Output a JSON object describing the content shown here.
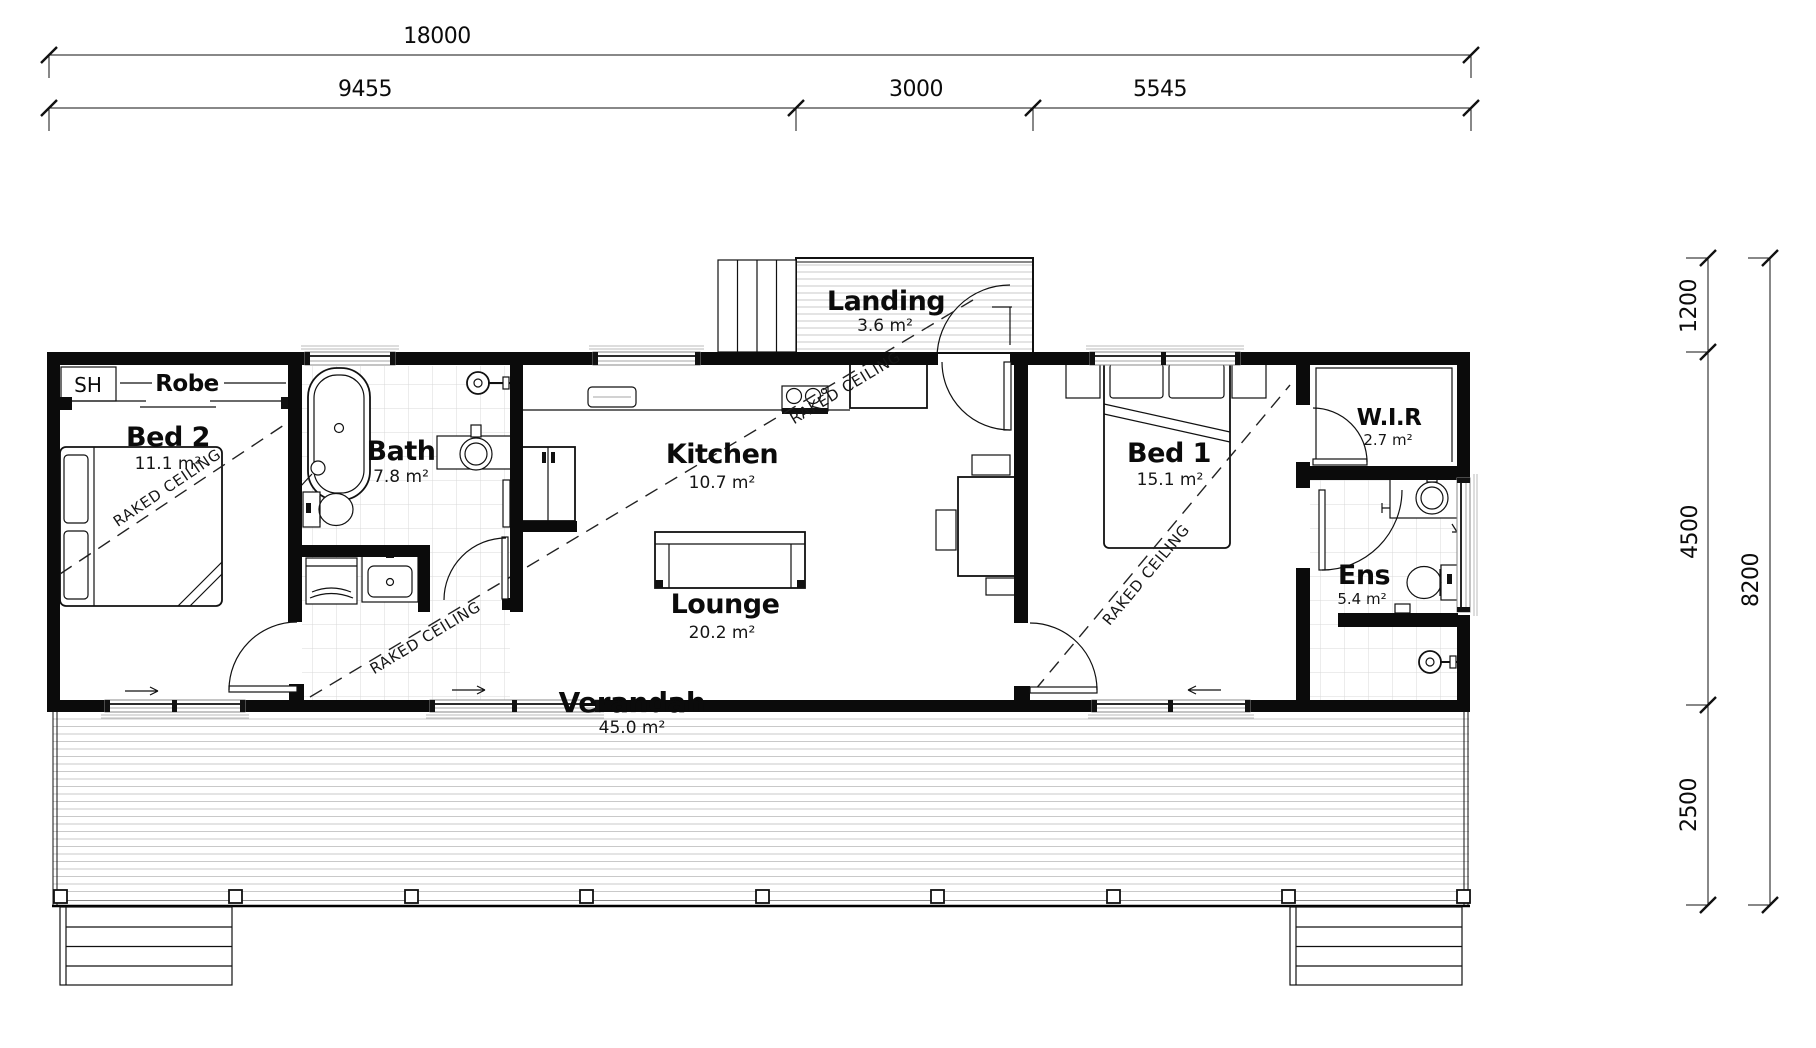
{
  "dimensions": {
    "top": {
      "overall": "18000",
      "seg1": "9455",
      "seg2": "3000",
      "seg3": "5545"
    },
    "right": {
      "overall": "8200",
      "seg1": "1200",
      "seg2": "4500",
      "seg3": "2500"
    }
  },
  "rooms": {
    "bed2": {
      "name": "Bed 2",
      "area": "11.1 m²"
    },
    "robe": {
      "name": "Robe"
    },
    "sh": {
      "name": "SH"
    },
    "bath": {
      "name": "Bath",
      "area": "7.8 m²"
    },
    "kitchen": {
      "name": "Kitchen",
      "area": "10.7 m²"
    },
    "lounge": {
      "name": "Lounge",
      "area": "20.2 m²"
    },
    "landing": {
      "name": "Landing",
      "area": "3.6 m²"
    },
    "bed1": {
      "name": "Bed 1",
      "area": "15.1 m²"
    },
    "wir": {
      "name": "W.I.R",
      "area": "2.7 m²"
    },
    "ens": {
      "name": "Ens",
      "area": "5.4 m²"
    },
    "verandah": {
      "name": "Verandah",
      "area": "45.0 m²"
    }
  },
  "annotations": {
    "raked_ceiling": "RAKED CEILING"
  }
}
